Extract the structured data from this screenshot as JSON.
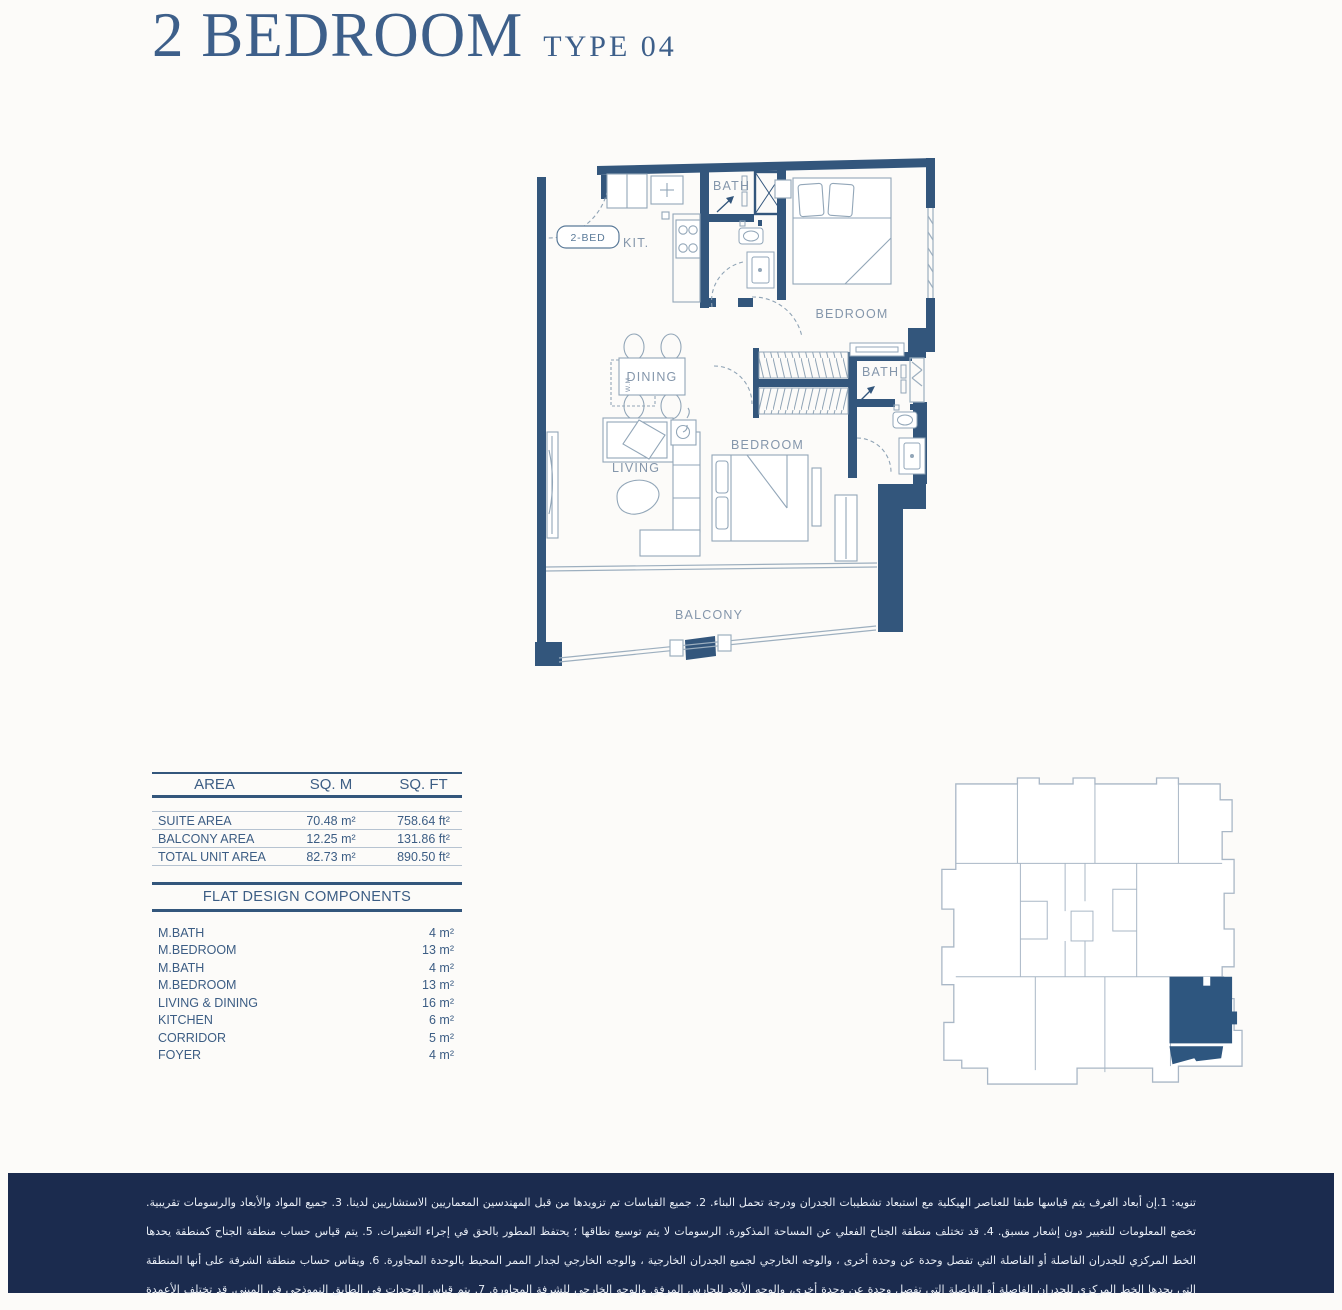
{
  "page": {
    "background": "#fcfbf9",
    "accent_navy": "#33567c",
    "banner_navy": "#1b2b4e",
    "furniture_gray": "#92a6b8",
    "keyplan_outline": "#a9b7c6",
    "keyplan_highlight": "#2e567f"
  },
  "header": {
    "title": "2 BEDROOM",
    "subtitle": "TYPE 04"
  },
  "floor_plan": {
    "labels": {
      "entry_tag": "2-BED",
      "kitchen": "KIT.",
      "bath_top": "BATH",
      "bedroom_top": "BEDROOM",
      "dining": "DINING",
      "living": "LIVING",
      "bedroom_mid": "BEDROOM",
      "bath_right": "BATH",
      "balcony": "BALCONY",
      "washing_machine": "W.M"
    }
  },
  "area_table": {
    "headers": [
      "AREA",
      "SQ. M",
      "SQ. FT"
    ],
    "rows": [
      {
        "label": "SUITE AREA",
        "sqm": "70.48 m²",
        "sqft": "758.64 ft²"
      },
      {
        "label": "BALCONY AREA",
        "sqm": "12.25 m²",
        "sqft": "131.86 ft²"
      },
      {
        "label": "TOTAL UNIT AREA",
        "sqm": "82.73 m²",
        "sqft": "890.50 ft²"
      }
    ]
  },
  "components": {
    "title": "FLAT DESIGN COMPONENTS",
    "rows": [
      {
        "label": "M.BATH",
        "value": "4 m²"
      },
      {
        "label": "M.BEDROOM",
        "value": "13 m²"
      },
      {
        "label": "M.BATH",
        "value": "4 m²"
      },
      {
        "label": "M.BEDROOM",
        "value": "13 m²"
      },
      {
        "label": "LIVING & DINING",
        "value": "16 m²"
      },
      {
        "label": "KITCHEN",
        "value": "6 m²"
      },
      {
        "label": "CORRIDOR",
        "value": "5 m²"
      },
      {
        "label": "FOYER",
        "value": "4 m²"
      }
    ]
  },
  "disclaimer": {
    "text": "تنويه: 1.إن أبعاد الغرف يتم قياسها طبقا للعناصر الهيكلية مع استبعاد تشطيبات الجدران ودرجة تحمل البناء. 2. جميع القياسات تم تزويدها من قبل المهندسين المعماريين الاستشاريين لدينا. 3. جميع المواد والأبعاد والرسومات تقريبية. تخضع المعلومات للتغيير دون إشعار مسبق. 4. قد تختلف منطقة الجناح الفعلي عن المساحة المذكورة. الرسومات لا يتم توسيع نطاقها ؛ يحتفظ المطور بالحق في إجراء التغييرات. 5. يتم قياس حساب منطقة الجناح كمنطقة يحدها الخط المركزي للجدران الفاصلة أو الفاصلة التي تفصل وحدة عن وحدة أخرى ، والوجه الخارجي لجميع الجدران الخارجية ، والوجه الخارجي لجدار الممر المحيط بالوحدة المجاورة. 6. ويقاس حساب منطقة الشرفة على أنها المنطقة التي يحدها الخط المركزي للجدران الفاصلة أو الفاصلة التي تفصل وحدة عن وحدة أخرى، والوجه الأبعد للحارس المرفق والوجه الخارجي للشرفة المجاورة. 7. يتم قياس الوحدات في الطابق النموذجي في المبنى. قد تختلف الأعمدة في الحجم حسب مستوى الطابق. 8. قد تكون احجام الوحدات والتفاصيل المتعلقة بها مختلفة وذلك حسب نوع الوحدة . يرجى الرجوع إلى اتفاقية البيع والشراء لمعرفة الحجم الفعلي لكل وحدة."
  }
}
